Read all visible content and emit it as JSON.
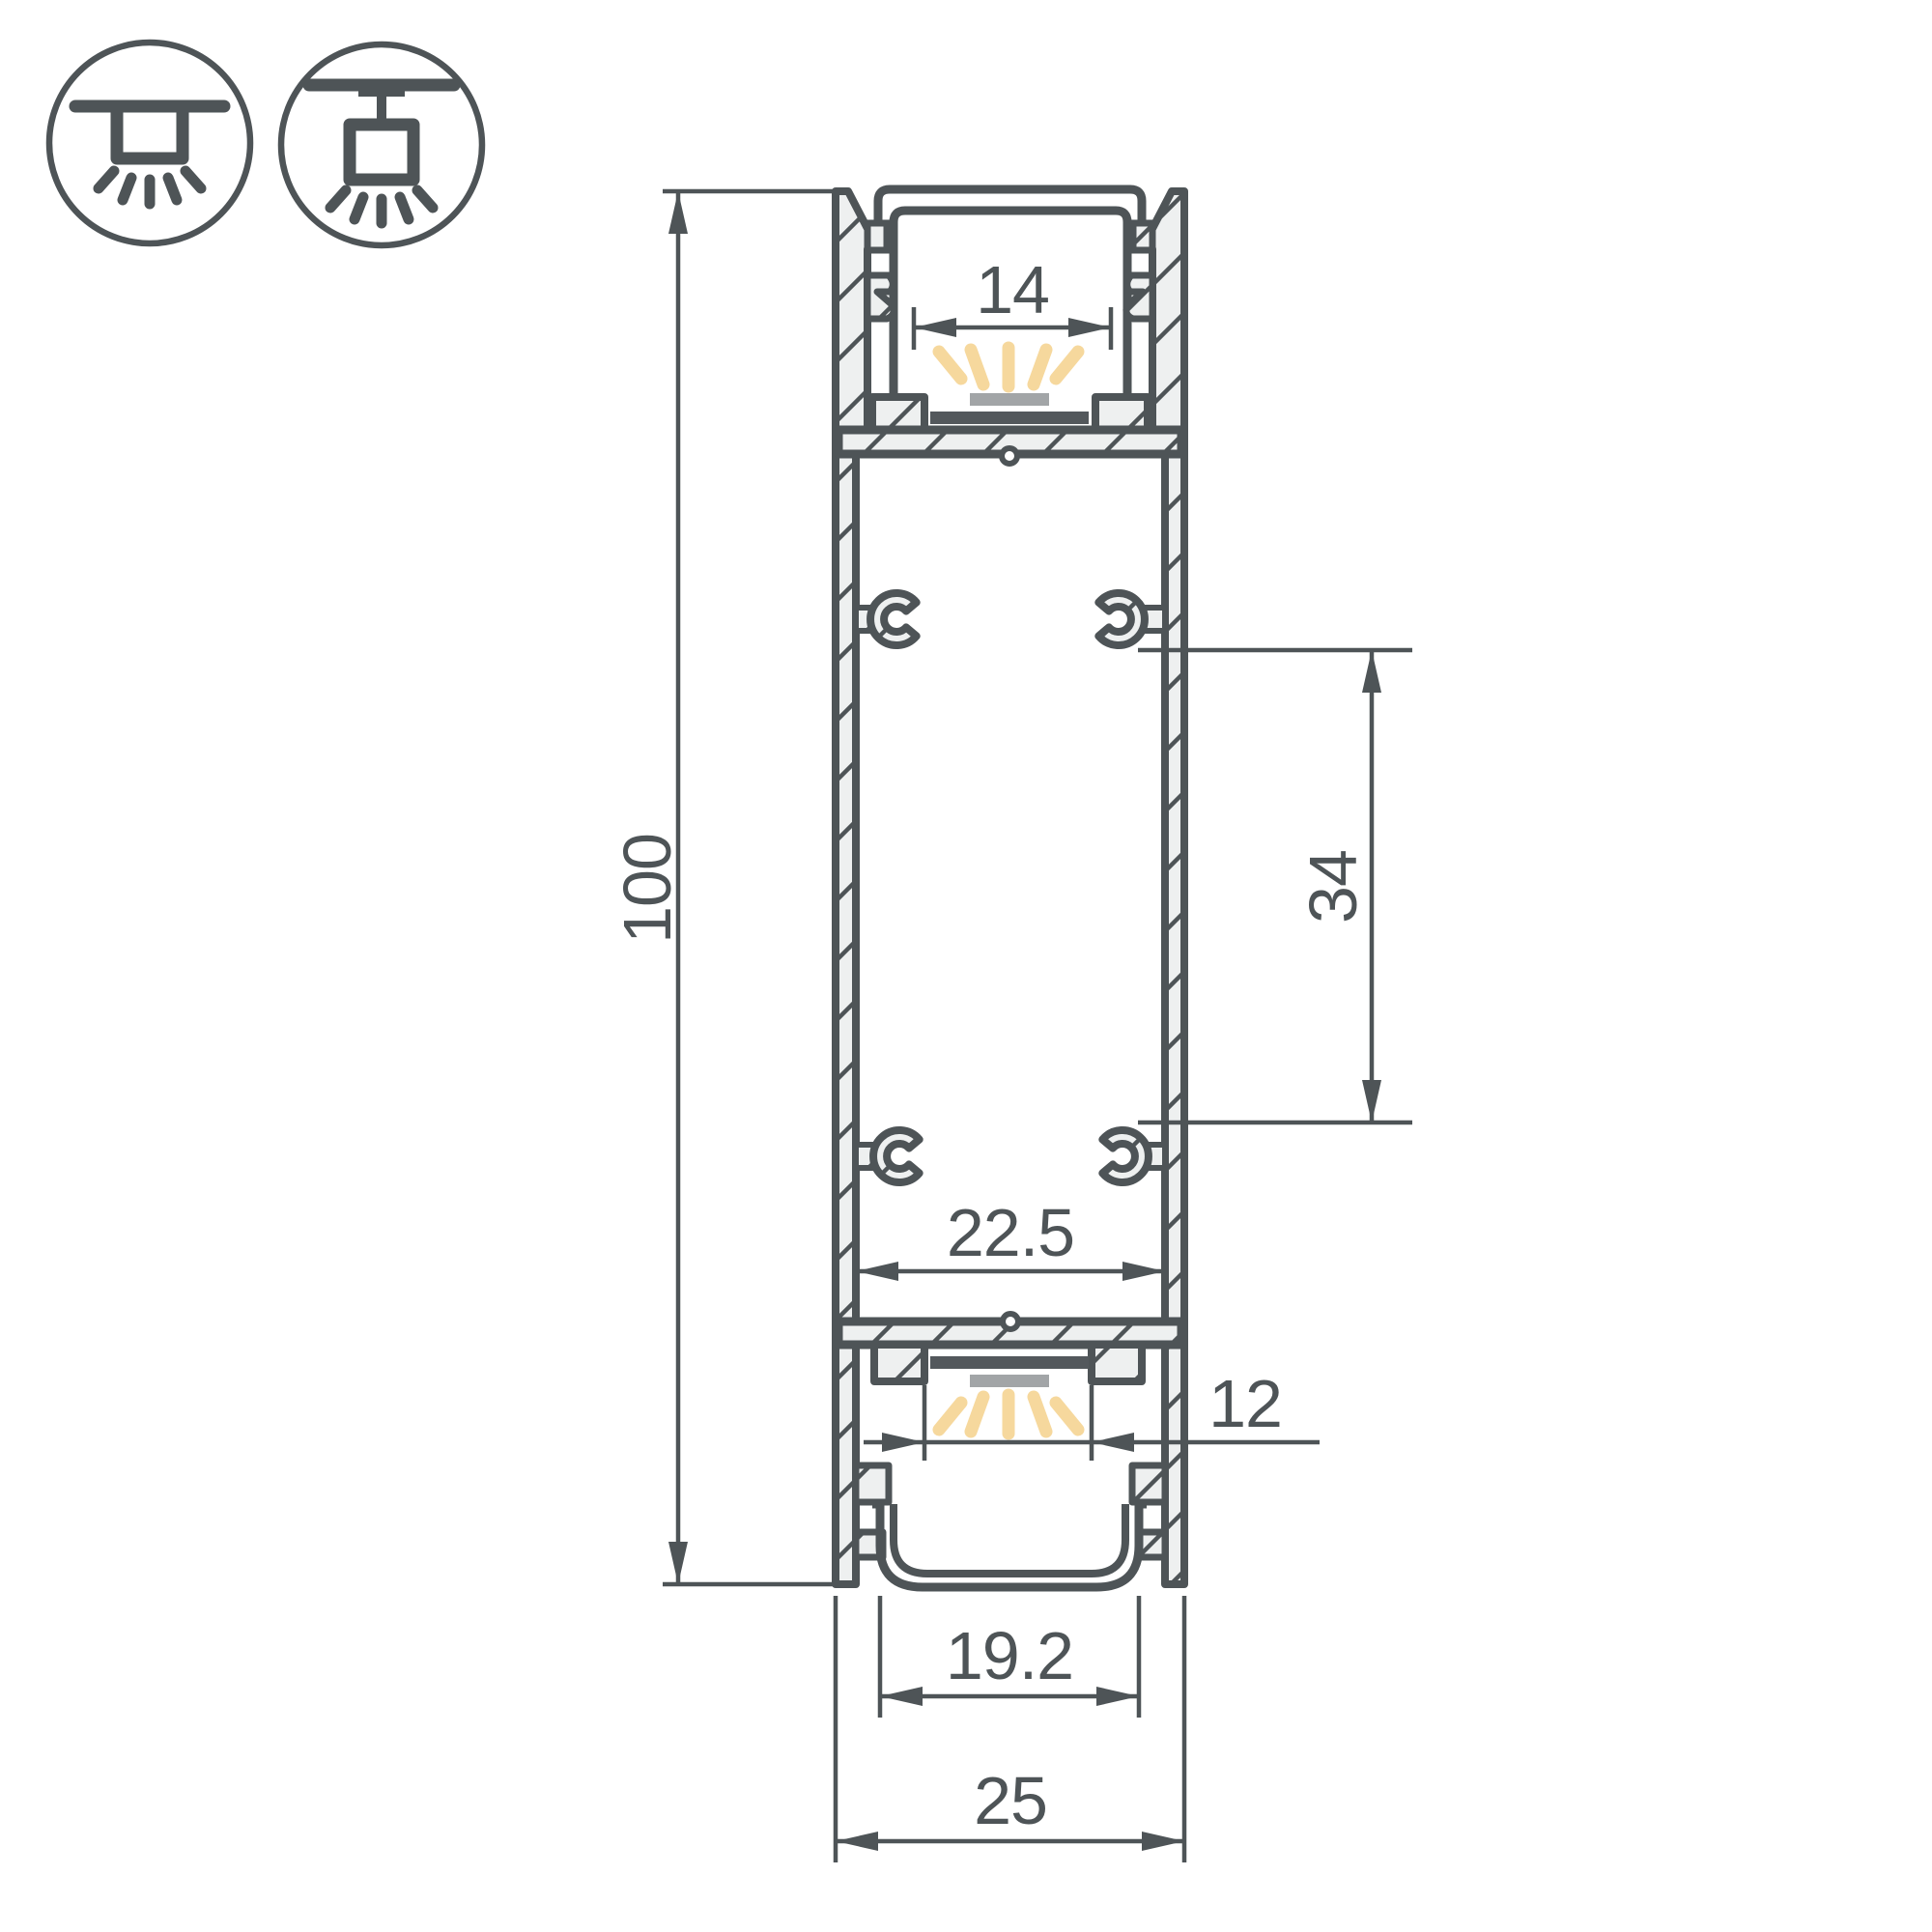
{
  "drawing": {
    "type": "technical-cross-section",
    "subject": "double-emission LED aluminium profile"
  },
  "mounting_icons": [
    {
      "name": "surface-ceiling-mount"
    },
    {
      "name": "pendant-suspension-mount"
    }
  ],
  "dimensions": {
    "overall_height": "100",
    "top_window_width": "14",
    "clip_spacing": "34",
    "inner_width": "22.5",
    "bottom_led_width": "12",
    "bottom_opening_width": "19.2",
    "overall_width": "25"
  },
  "colors": {
    "line": "#4e5457",
    "hatch_fill": "#eef0f0",
    "light_ray": "#f6d89d",
    "led_strip_gray": "#a2a5a7",
    "pcb_dark": "#53585c",
    "background": "#ffffff"
  }
}
